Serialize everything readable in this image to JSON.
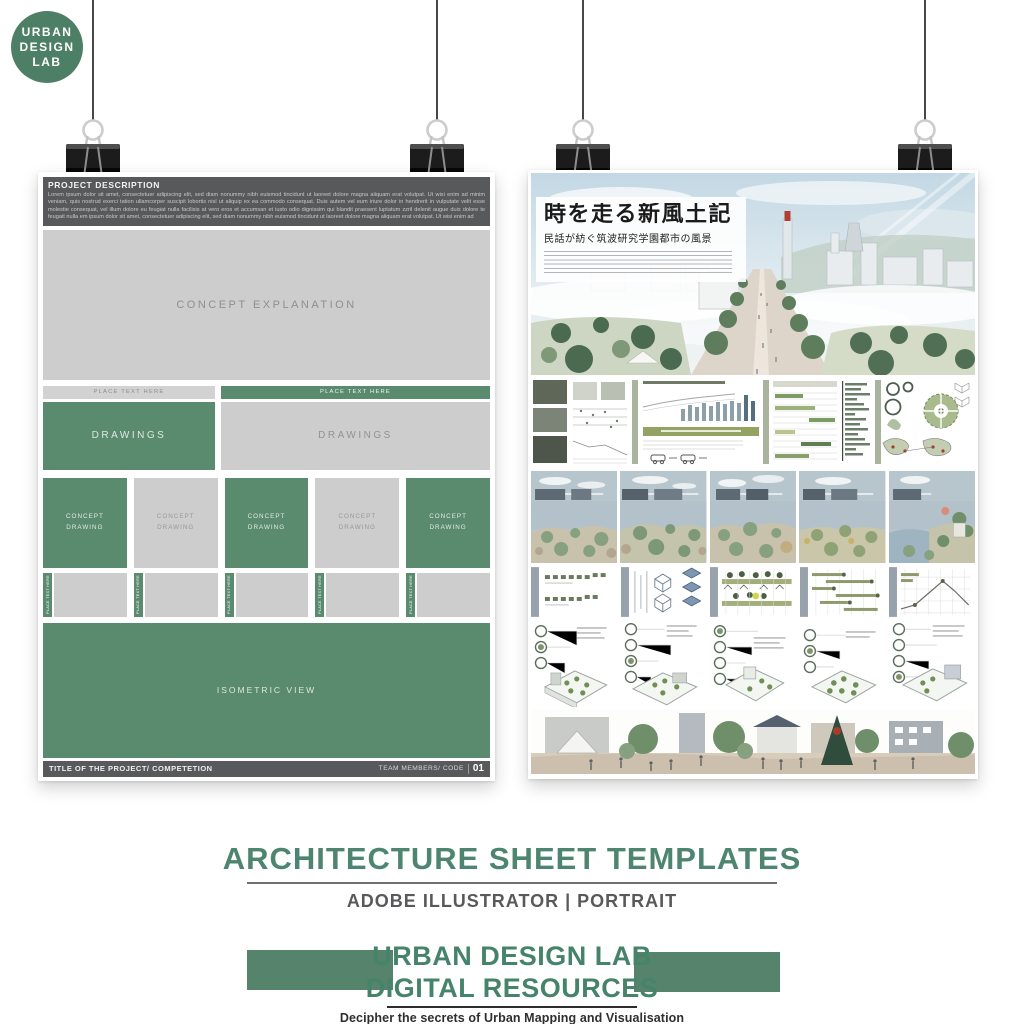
{
  "logo": {
    "line1": "URBAN",
    "line2": "DESIGN",
    "line3": "LAB"
  },
  "left_poster": {
    "header_title": "PROJECT DESCRIPTION",
    "header_body": "Lorem ipsum dolor sit amet, consectetuer adipiscing elit, sed diam nonummy nibh euismod tincidunt ut laoreet dolore magna aliquam erat volutpat. Ut wisi enim ad minim veniam, quis nostrud exerci tation ullamcorper suscipit lobortis nisl ut aliquip ex ea commodo consequat. Duis autem vel eum iriure dolor in hendrerit in vulputate velit esse molestie consequat, vel illum dolore eu feugiat nulla facilisis at vero eros et accumsan et iusto odio dignissim qui blandit praesent luptatum zzril delenit augue duis dolore te feugait nulla em ipsum dolor sit amet, consectetuer adipiscing elit, sed diam nonummy nibh euismod tincidunt ut laoreet dolore magna aliquam erat volutpat. Ut wisi enim ad",
    "concept_explanation_label": "CONCEPT EXPLANATION",
    "place_text_label": "PLACE TEXT HERE",
    "drawings_label": "DRAWINGS",
    "concept_drawing_label": "CONCEPT\nDRAWING",
    "isometric_label": "ISOMETRIC VIEW",
    "footer_title": "TITLE OF THE PROJECT/ COMPETETION",
    "footer_right_label": "TEAM MEMBERS/ CODE",
    "footer_number": "01"
  },
  "right_poster": {
    "title": "時を走る新風土記",
    "subtitle": "民話が紡ぐ筑波研究学園都市の風景"
  },
  "caption": {
    "heading": "ARCHITECTURE SHEET TEMPLATES",
    "subheading": "ADOBE ILLUSTRATOR | PORTRAIT"
  },
  "brand": {
    "line1": "URBAN DESIGN LAB",
    "line2": "DIGITAL RESOURCES",
    "tagline": "Decipher the secrets of Urban Mapping and Visualisation"
  },
  "colors": {
    "template_green": "#5b8b6e",
    "header_gray": "#58595b",
    "panel_gray": "#cdcdcd",
    "brand_green": "#46836b"
  }
}
